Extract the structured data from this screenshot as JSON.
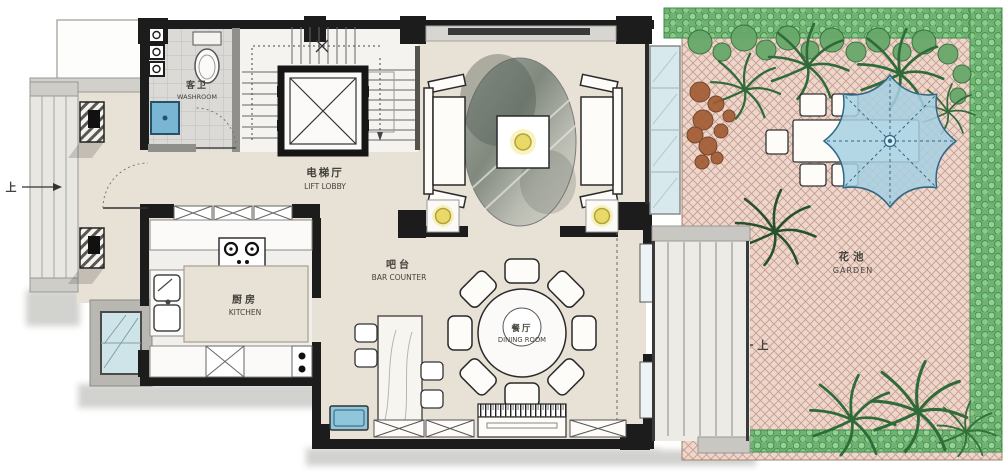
{
  "rooms": {
    "washroom": {
      "zh": "客卫",
      "en": "WASHROOM"
    },
    "lift_lobby": {
      "zh": "电梯厅",
      "en": "LIFT LOBBY"
    },
    "kitchen": {
      "zh": "厨房",
      "en": "KITCHEN"
    },
    "bar_counter": {
      "zh": "吧台",
      "en": "BAR COUNTER"
    },
    "dining_room": {
      "zh": "餐厅",
      "en": "DINING ROOM"
    },
    "garden": {
      "zh": "花池",
      "en": "GARDEN"
    }
  },
  "annotations": {
    "up_left": "上",
    "up_right": "上"
  },
  "colors": {
    "wall": "#1c1c1c",
    "floor": "#e8e1d6",
    "tile_floor": "#dbdad6",
    "kitchen_floor": "#f1efeb",
    "paving": "#eed6cd",
    "paving_line": "#c49e8e",
    "hedge": "#8cc98b",
    "foliage": "#2f6b38",
    "shrub_brown": "#a05a31",
    "umbrella": "#a7d0e3",
    "glass": "#d7e9ec",
    "basin_blue": "#79b6d4",
    "light_yellow": "#e9d968",
    "label_text": "#44423c"
  }
}
